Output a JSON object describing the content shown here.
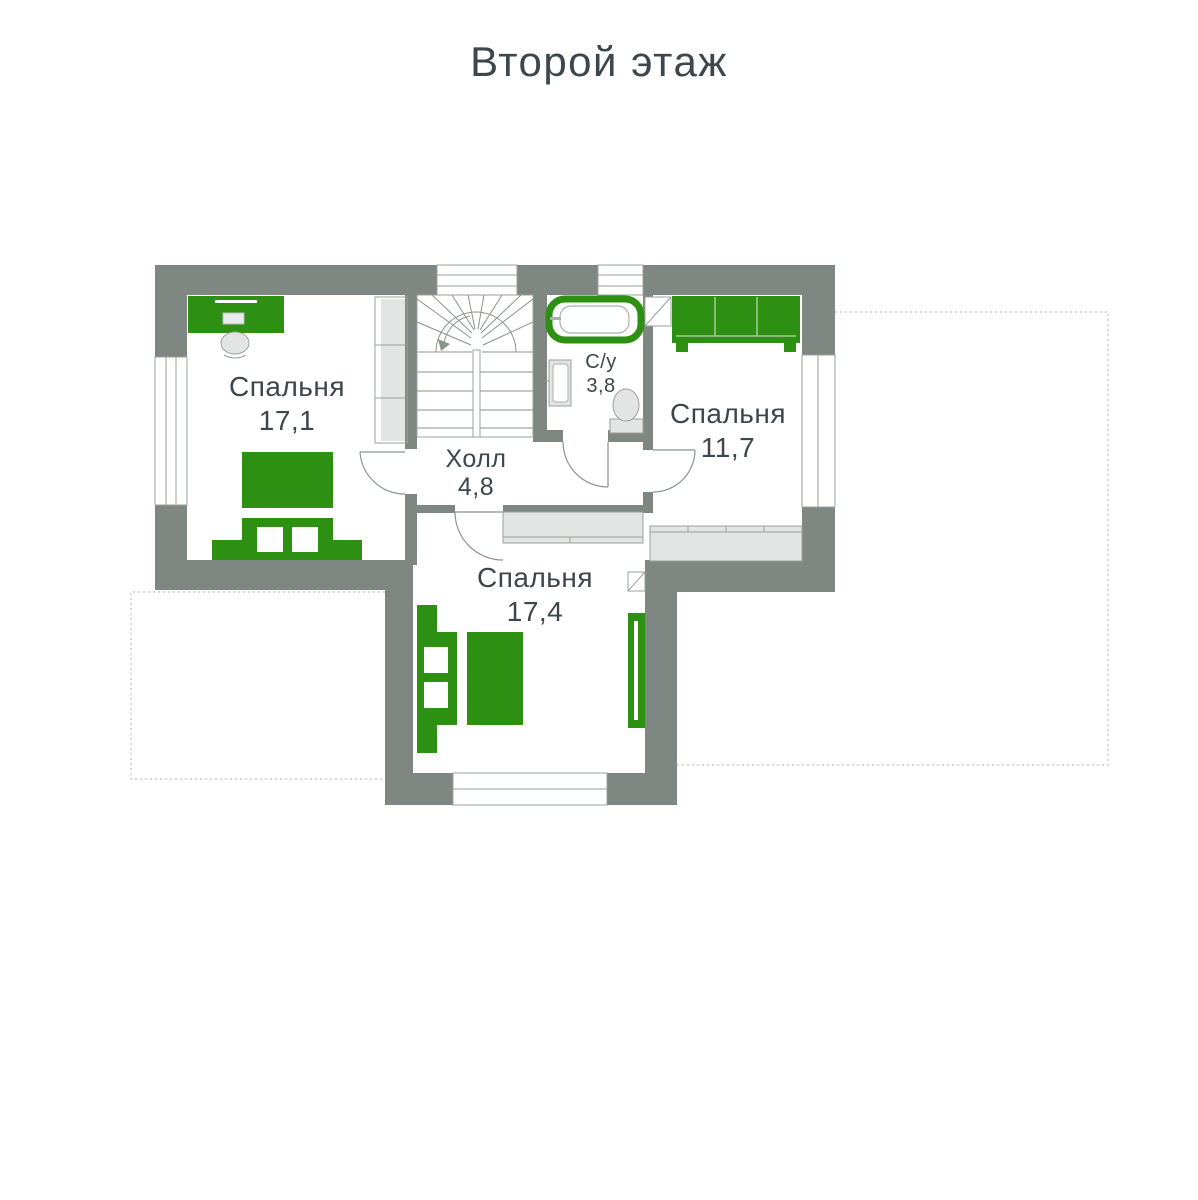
{
  "title": "Второй этаж",
  "colors": {
    "wall": "#7e8781",
    "green": "#2e9013",
    "light": "#e3e5e4",
    "stroke": "#9aa19c",
    "text": "#3d464a",
    "dash": "#c9cdca"
  },
  "rooms": [
    {
      "id": "bedroom-17-1",
      "name": "Спальня",
      "area": "17,1"
    },
    {
      "id": "bedroom-11-7",
      "name": "Спальня",
      "area": "11,7"
    },
    {
      "id": "bedroom-17-4",
      "name": "Спальня",
      "area": "17,4"
    },
    {
      "id": "hall",
      "name": "Холл",
      "area": "4,8"
    },
    {
      "id": "bathroom",
      "name": "С/у",
      "area": "3,8"
    }
  ]
}
